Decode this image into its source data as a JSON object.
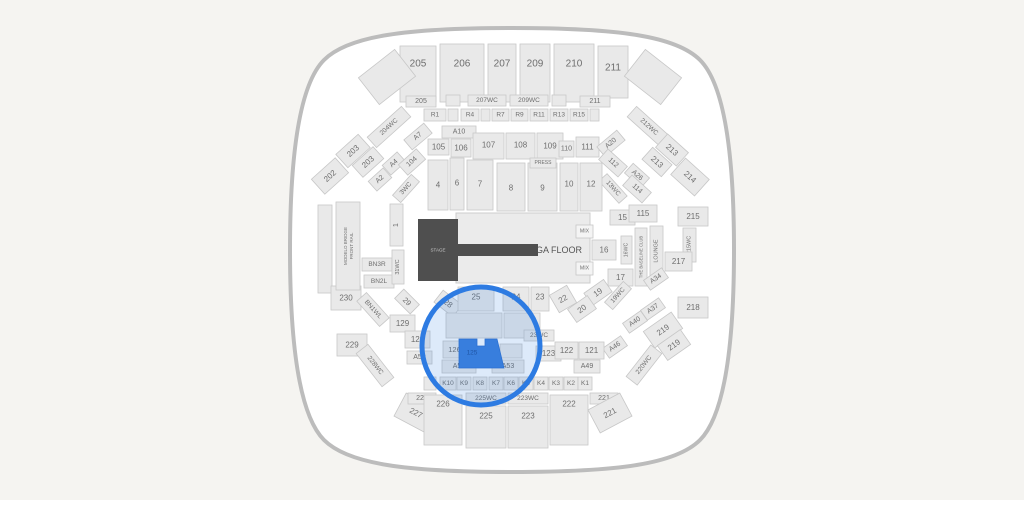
{
  "page": {
    "background": "#f5f4f1"
  },
  "arena": {
    "fill": "#ffffff",
    "outline": "#bcbcbc"
  },
  "styles": {
    "section_fill": "#e9e9e9",
    "section_stroke": "#c7c7c7",
    "label_color": "#6e6e6e",
    "stage_fill": "#4f4f4f",
    "stage_text": "#c9c9c9",
    "ga_fill": "#ebebeb",
    "ga_stroke": "#cccccc",
    "highlight_ring": "#2d7be2",
    "highlight_fill": "#2d7be2",
    "highlight_fill_opacity": 0.16,
    "selected_fill": "#3b7fdd",
    "selected_stroke": "#2d6fd0",
    "selected_text": "#1d4e9b"
  },
  "stage": {
    "label": "STAGE"
  },
  "ga_floor": {
    "label": "GA FLOOR"
  },
  "highlight": {
    "selected_section": "125"
  },
  "sections": [
    {
      "t": "205",
      "x": 400,
      "y": 46,
      "w": 36,
      "h": 56,
      "fs": 10,
      "ly": 64
    },
    {
      "t": "",
      "x": 364,
      "y": 60,
      "w": 46,
      "h": 34,
      "r": -38
    },
    {
      "t": "206",
      "x": 440,
      "y": 44,
      "w": 44,
      "h": 58,
      "fs": 10,
      "ly": 64
    },
    {
      "t": "207",
      "x": 488,
      "y": 44,
      "w": 28,
      "h": 58,
      "fs": 10,
      "ly": 64
    },
    {
      "t": "209",
      "x": 520,
      "y": 44,
      "w": 30,
      "h": 58,
      "fs": 10,
      "ly": 64
    },
    {
      "t": "210",
      "x": 554,
      "y": 44,
      "w": 40,
      "h": 58,
      "fs": 10,
      "ly": 64
    },
    {
      "t": "211",
      "x": 598,
      "y": 46,
      "w": 30,
      "h": 52,
      "fs": 10,
      "ly": 68
    },
    {
      "t": "",
      "x": 630,
      "y": 60,
      "w": 46,
      "h": 34,
      "r": 38
    },
    {
      "t": "205",
      "x": 406,
      "y": 96,
      "w": 30,
      "h": 11,
      "fs": 7
    },
    {
      "t": "",
      "x": 446,
      "y": 95,
      "w": 14,
      "h": 11
    },
    {
      "t": "207WC",
      "x": 468,
      "y": 95,
      "w": 38,
      "h": 11,
      "fs": 6.5
    },
    {
      "t": "209WC",
      "x": 510,
      "y": 95,
      "w": 38,
      "h": 11,
      "fs": 6.5
    },
    {
      "t": "",
      "x": 552,
      "y": 95,
      "w": 14,
      "h": 11
    },
    {
      "t": "211",
      "x": 580,
      "y": 96,
      "w": 30,
      "h": 11,
      "fs": 7
    },
    {
      "t": "R1",
      "x": 424,
      "y": 109,
      "w": 22,
      "h": 12,
      "fs": 6.5
    },
    {
      "t": "",
      "x": 448,
      "y": 109,
      "w": 10,
      "h": 12
    },
    {
      "t": "R4",
      "x": 461,
      "y": 109,
      "w": 18,
      "h": 12,
      "fs": 6.5
    },
    {
      "t": "",
      "x": 481,
      "y": 109,
      "w": 9,
      "h": 12
    },
    {
      "t": "R7",
      "x": 492,
      "y": 109,
      "w": 17,
      "h": 12,
      "fs": 6.5
    },
    {
      "t": "R9",
      "x": 511,
      "y": 109,
      "w": 17,
      "h": 12,
      "fs": 6.5
    },
    {
      "t": "R11",
      "x": 530,
      "y": 109,
      "w": 18,
      "h": 12,
      "fs": 6.5
    },
    {
      "t": "R13",
      "x": 550,
      "y": 109,
      "w": 18,
      "h": 12,
      "fs": 6.5
    },
    {
      "t": "R15",
      "x": 570,
      "y": 109,
      "w": 18,
      "h": 12,
      "fs": 6.5
    },
    {
      "t": "",
      "x": 590,
      "y": 109,
      "w": 9,
      "h": 12
    },
    {
      "t": "A7",
      "x": 405,
      "y": 130,
      "w": 26,
      "h": 13,
      "r": -40,
      "fs": 7
    },
    {
      "t": "A10",
      "x": 442,
      "y": 126,
      "w": 34,
      "h": 12,
      "fs": 7
    },
    {
      "t": "105",
      "x": 428,
      "y": 139,
      "w": 21,
      "h": 16,
      "fs": 8
    },
    {
      "t": "106",
      "x": 451,
      "y": 139,
      "w": 20,
      "h": 18,
      "fs": 8
    },
    {
      "t": "107",
      "x": 473,
      "y": 133,
      "w": 31,
      "h": 26,
      "fs": 8,
      "ly": 145
    },
    {
      "t": "108",
      "x": 506,
      "y": 133,
      "w": 29,
      "h": 26,
      "fs": 8,
      "ly": 145
    },
    {
      "t": "109",
      "x": 537,
      "y": 133,
      "w": 26,
      "h": 26,
      "fs": 8,
      "ly": 146
    },
    {
      "t": "110",
      "x": 559,
      "y": 141,
      "w": 15,
      "h": 16,
      "fs": 7
    },
    {
      "t": "111",
      "x": 576,
      "y": 137,
      "w": 23,
      "h": 20,
      "fs": 8
    },
    {
      "t": "A20",
      "x": 598,
      "y": 137,
      "w": 26,
      "h": 13,
      "r": -40,
      "fs": 7
    },
    {
      "t": "204WC",
      "x": 366,
      "y": 120,
      "w": 46,
      "h": 14,
      "r": -42,
      "fs": 6.5
    },
    {
      "t": "203",
      "x": 338,
      "y": 142,
      "w": 30,
      "h": 18,
      "r": -42,
      "fs": 8
    },
    {
      "t": "203",
      "x": 354,
      "y": 154,
      "w": 28,
      "h": 16,
      "r": -42,
      "fs": 8
    },
    {
      "t": "202",
      "x": 314,
      "y": 166,
      "w": 32,
      "h": 20,
      "r": -42,
      "fs": 8
    },
    {
      "t": "A4",
      "x": 384,
      "y": 157,
      "w": 20,
      "h": 13,
      "r": -42,
      "fs": 7
    },
    {
      "t": "104",
      "x": 400,
      "y": 155,
      "w": 24,
      "h": 14,
      "r": -42,
      "fs": 7
    },
    {
      "t": "A2",
      "x": 370,
      "y": 173,
      "w": 20,
      "h": 13,
      "r": -42,
      "fs": 7
    },
    {
      "t": "3WC",
      "x": 392,
      "y": 183,
      "w": 28,
      "h": 11,
      "r": -48,
      "fs": 6.5
    },
    {
      "t": "212WC",
      "x": 626,
      "y": 120,
      "w": 46,
      "h": 14,
      "r": 42,
      "fs": 6.5
    },
    {
      "t": "213",
      "x": 658,
      "y": 141,
      "w": 28,
      "h": 18,
      "r": 42,
      "fs": 8
    },
    {
      "t": "213",
      "x": 644,
      "y": 154,
      "w": 26,
      "h": 16,
      "r": 42,
      "fs": 8
    },
    {
      "t": "214",
      "x": 674,
      "y": 166,
      "w": 32,
      "h": 22,
      "r": 42,
      "fs": 8
    },
    {
      "t": "112",
      "x": 600,
      "y": 156,
      "w": 26,
      "h": 14,
      "r": 42,
      "fs": 7
    },
    {
      "t": "A26",
      "x": 626,
      "y": 169,
      "w": 22,
      "h": 13,
      "r": 42,
      "fs": 7
    },
    {
      "t": "13WC",
      "x": 598,
      "y": 183,
      "w": 30,
      "h": 11,
      "r": 48,
      "fs": 6.5
    },
    {
      "t": "114",
      "x": 624,
      "y": 182,
      "w": 26,
      "h": 14,
      "r": 42,
      "fs": 7
    },
    {
      "t": "4",
      "x": 428,
      "y": 160,
      "w": 20,
      "h": 50,
      "fs": 8,
      "ly": 185
    },
    {
      "t": "6",
      "x": 450,
      "y": 158,
      "w": 14,
      "h": 52,
      "fs": 8,
      "ly": 183
    },
    {
      "t": "7",
      "x": 467,
      "y": 160,
      "w": 26,
      "h": 50,
      "fs": 8,
      "ly": 184
    },
    {
      "t": "8",
      "x": 497,
      "y": 163,
      "w": 28,
      "h": 48,
      "fs": 8,
      "ly": 188
    },
    {
      "t": "9",
      "x": 528,
      "y": 163,
      "w": 29,
      "h": 48,
      "fs": 8,
      "ly": 188
    },
    {
      "t": "PRESS",
      "x": 530,
      "y": 158,
      "w": 26,
      "h": 10,
      "fs": 5
    },
    {
      "t": "10",
      "x": 560,
      "y": 163,
      "w": 18,
      "h": 48,
      "fs": 8,
      "ly": 184
    },
    {
      "t": "12",
      "x": 580,
      "y": 163,
      "w": 22,
      "h": 48,
      "fs": 8,
      "ly": 184
    },
    {
      "t": "1",
      "x": 390,
      "y": 204,
      "w": 13,
      "h": 42,
      "v": true,
      "fs": 7
    },
    {
      "t": "",
      "x": 318,
      "y": 205,
      "w": 14,
      "h": 88
    },
    {
      "t": "15",
      "x": 610,
      "y": 210,
      "w": 25,
      "h": 15,
      "fs": 8
    },
    {
      "t": "115",
      "x": 629,
      "y": 205,
      "w": 28,
      "h": 17,
      "fs": 8
    },
    {
      "t": "215",
      "x": 678,
      "y": 207,
      "w": 30,
      "h": 19,
      "fs": 8
    },
    {
      "t": "215WC",
      "x": 683,
      "y": 228,
      "w": 13,
      "h": 34,
      "v": true,
      "fs": 5.5
    },
    {
      "t": "217",
      "x": 665,
      "y": 252,
      "w": 27,
      "h": 19,
      "fs": 8
    },
    {
      "t": "218",
      "x": 678,
      "y": 297,
      "w": 30,
      "h": 21,
      "fs": 8
    },
    {
      "t": "LOUNGE",
      "x": 650,
      "y": 226,
      "w": 13,
      "h": 50,
      "v": true,
      "fs": 5.5
    },
    {
      "t": "THE BASELINE CLUB",
      "x": 635,
      "y": 228,
      "w": 12,
      "h": 58,
      "v": true,
      "fs": 4.2
    },
    {
      "t": "16WC",
      "x": 621,
      "y": 236,
      "w": 11,
      "h": 28,
      "v": true,
      "fs": 5.2
    },
    {
      "t": "16",
      "x": 592,
      "y": 240,
      "w": 24,
      "h": 20,
      "fs": 8
    },
    {
      "t": "MIX",
      "x": 576,
      "y": 225,
      "w": 17,
      "h": 13,
      "fs": 5.2,
      "f": "#f4f4f4"
    },
    {
      "t": "MIX",
      "x": 576,
      "y": 262,
      "w": 17,
      "h": 13,
      "fs": 5.2,
      "f": "#f4f4f4"
    },
    {
      "t": "17",
      "x": 608,
      "y": 269,
      "w": 25,
      "h": 17,
      "fs": 8
    },
    {
      "t": "A34",
      "x": 645,
      "y": 273,
      "w": 22,
      "h": 12,
      "r": -35,
      "fs": 7
    },
    {
      "t": "19WC",
      "x": 604,
      "y": 290,
      "w": 28,
      "h": 11,
      "r": -48,
      "fs": 6.5
    },
    {
      "t": "19",
      "x": 586,
      "y": 285,
      "w": 24,
      "h": 15,
      "r": -35,
      "fs": 8
    },
    {
      "t": "20",
      "x": 570,
      "y": 301,
      "w": 24,
      "h": 16,
      "r": -35,
      "fs": 8
    },
    {
      "t": "A37",
      "x": 642,
      "y": 303,
      "w": 22,
      "h": 12,
      "r": -35,
      "fs": 7
    },
    {
      "t": "A40",
      "x": 624,
      "y": 316,
      "w": 22,
      "h": 12,
      "r": -35,
      "fs": 7
    },
    {
      "t": "A46",
      "x": 604,
      "y": 341,
      "w": 22,
      "h": 12,
      "r": -35,
      "fs": 7
    },
    {
      "t": "219",
      "x": 646,
      "y": 320,
      "w": 34,
      "h": 20,
      "r": -35,
      "fs": 8
    },
    {
      "t": "219",
      "x": 660,
      "y": 336,
      "w": 28,
      "h": 18,
      "r": -35,
      "fs": 8
    },
    {
      "t": "220WC",
      "x": 624,
      "y": 358,
      "w": 40,
      "h": 14,
      "r": -52,
      "fs": 6.5
    },
    {
      "t": "230",
      "x": 331,
      "y": 286,
      "w": 30,
      "h": 24,
      "fs": 8
    },
    {
      "t": "MODELO BRIDGE|FRONT RAIL",
      "x": 336,
      "y": 202,
      "w": 24,
      "h": 88,
      "v": true,
      "fs": 4.5
    },
    {
      "t": "BN3R",
      "x": 362,
      "y": 258,
      "w": 30,
      "h": 13,
      "fs": 6.5
    },
    {
      "t": "BN2L",
      "x": 364,
      "y": 275,
      "w": 30,
      "h": 13,
      "fs": 6.5
    },
    {
      "t": "BN1WL",
      "x": 356,
      "y": 303,
      "w": 34,
      "h": 13,
      "r": 48,
      "fs": 6.5
    },
    {
      "t": "31WC",
      "x": 392,
      "y": 250,
      "w": 12,
      "h": 34,
      "v": true,
      "fs": 5.5
    },
    {
      "t": "29",
      "x": 396,
      "y": 295,
      "w": 22,
      "h": 13,
      "r": 45,
      "fs": 7.5
    },
    {
      "t": "28",
      "x": 436,
      "y": 296,
      "w": 24,
      "h": 15,
      "r": 38,
      "fs": 8
    },
    {
      "t": "129",
      "x": 390,
      "y": 315,
      "w": 25,
      "h": 17,
      "fs": 8
    },
    {
      "t": "128",
      "x": 405,
      "y": 331,
      "w": 25,
      "h": 17,
      "fs": 8
    },
    {
      "t": "A59",
      "x": 407,
      "y": 351,
      "w": 25,
      "h": 13,
      "fs": 7
    },
    {
      "t": "229",
      "x": 337,
      "y": 334,
      "w": 30,
      "h": 22,
      "fs": 8
    },
    {
      "t": "228WC",
      "x": 354,
      "y": 358,
      "w": 42,
      "h": 15,
      "r": 52,
      "fs": 6.5
    },
    {
      "t": "25",
      "x": 458,
      "y": 287,
      "w": 36,
      "h": 24,
      "fs": 8,
      "ly": 297
    },
    {
      "t": "24",
      "x": 503,
      "y": 287,
      "w": 26,
      "h": 24,
      "fs": 8,
      "ly": 297
    },
    {
      "t": "23",
      "x": 531,
      "y": 287,
      "w": 18,
      "h": 24,
      "fs": 8,
      "ly": 297
    },
    {
      "t": "22",
      "x": 553,
      "y": 289,
      "w": 20,
      "h": 20,
      "r": -30,
      "fs": 8
    },
    {
      "t": "",
      "x": 446,
      "y": 313,
      "w": 56,
      "h": 25
    },
    {
      "t": "",
      "x": 504,
      "y": 313,
      "w": 36,
      "h": 25
    },
    {
      "t": "23WC",
      "x": 524,
      "y": 330,
      "w": 30,
      "h": 11,
      "fs": 6.5
    },
    {
      "t": "123",
      "x": 536,
      "y": 346,
      "w": 25,
      "h": 15,
      "fs": 8
    },
    {
      "t": "122",
      "x": 555,
      "y": 342,
      "w": 23,
      "h": 17,
      "fs": 8
    },
    {
      "t": "121",
      "x": 579,
      "y": 342,
      "w": 25,
      "h": 17,
      "fs": 8
    },
    {
      "t": "A49",
      "x": 574,
      "y": 360,
      "w": 26,
      "h": 13,
      "fs": 7
    },
    {
      "t": "126",
      "x": 443,
      "y": 341,
      "w": 23,
      "h": 17,
      "fs": 7.5
    },
    {
      "t": "",
      "x": 500,
      "y": 344,
      "w": 22,
      "h": 14
    },
    {
      "t": "A56",
      "x": 442,
      "y": 360,
      "w": 34,
      "h": 13,
      "fs": 7
    },
    {
      "t": "A53",
      "x": 492,
      "y": 360,
      "w": 32,
      "h": 13,
      "fs": 7
    },
    {
      "t": "",
      "x": 424,
      "y": 377,
      "w": 12,
      "h": 13
    },
    {
      "t": "K10",
      "x": 440,
      "y": 377,
      "w": 16,
      "h": 13,
      "fs": 6.5
    },
    {
      "t": "K9",
      "x": 457,
      "y": 377,
      "w": 14,
      "h": 13,
      "fs": 6.5
    },
    {
      "t": "K8",
      "x": 473,
      "y": 377,
      "w": 14,
      "h": 13,
      "fs": 6.5
    },
    {
      "t": "K7",
      "x": 489,
      "y": 377,
      "w": 14,
      "h": 13,
      "fs": 6.5
    },
    {
      "t": "K6",
      "x": 504,
      "y": 377,
      "w": 14,
      "h": 13,
      "fs": 6.5
    },
    {
      "t": "K5",
      "x": 519,
      "y": 377,
      "w": 14,
      "h": 13,
      "fs": 6.5
    },
    {
      "t": "K4",
      "x": 534,
      "y": 377,
      "w": 14,
      "h": 13,
      "fs": 6.5
    },
    {
      "t": "K3",
      "x": 549,
      "y": 377,
      "w": 14,
      "h": 13,
      "fs": 6.5
    },
    {
      "t": "K2",
      "x": 564,
      "y": 377,
      "w": 14,
      "h": 13,
      "fs": 6.5
    },
    {
      "t": "K1",
      "x": 578,
      "y": 377,
      "w": 14,
      "h": 13,
      "fs": 6.5
    },
    {
      "t": "227",
      "x": 398,
      "y": 400,
      "w": 36,
      "h": 26,
      "r": 28,
      "fs": 8
    },
    {
      "t": "227",
      "x": 408,
      "y": 393,
      "w": 28,
      "h": 11,
      "fs": 7
    },
    {
      "t": "226",
      "x": 424,
      "y": 395,
      "w": 38,
      "h": 50,
      "fs": 8,
      "ly": 404
    },
    {
      "t": "225WC",
      "x": 466,
      "y": 393,
      "w": 40,
      "h": 11,
      "fs": 6.5
    },
    {
      "t": "225",
      "x": 466,
      "y": 406,
      "w": 40,
      "h": 42,
      "fs": 8,
      "ly": 416
    },
    {
      "t": "223WC",
      "x": 508,
      "y": 393,
      "w": 40,
      "h": 11,
      "fs": 6.5
    },
    {
      "t": "223",
      "x": 508,
      "y": 406,
      "w": 40,
      "h": 42,
      "fs": 8,
      "ly": 416
    },
    {
      "t": "222",
      "x": 550,
      "y": 395,
      "w": 38,
      "h": 50,
      "fs": 8,
      "ly": 404
    },
    {
      "t": "221",
      "x": 590,
      "y": 393,
      "w": 28,
      "h": 11,
      "fs": 7
    },
    {
      "t": "221",
      "x": 592,
      "y": 400,
      "w": 36,
      "h": 26,
      "r": -28,
      "fs": 8
    }
  ]
}
